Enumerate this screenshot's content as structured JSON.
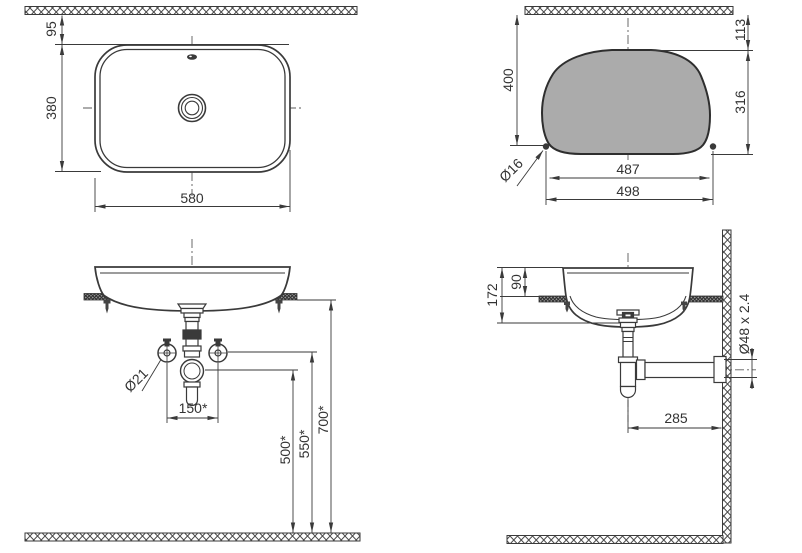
{
  "title": "washbasin installation drawing",
  "colors": {
    "line": "#3a3a3a",
    "cutout_fill": "#ababab",
    "text": "#333333"
  },
  "views": {
    "top": {
      "label": "top-view",
      "dims": {
        "wall_offset": "95",
        "depth": "380",
        "width": "580"
      }
    },
    "cutout": {
      "label": "cutout-template-view",
      "dims": {
        "wall_to_base": "400",
        "wall_to_top": "113",
        "height": "316",
        "hole": "Ø16",
        "width_inner": "487",
        "width_outer": "498"
      }
    },
    "front": {
      "label": "front-elevation",
      "dims": {
        "supply": "Ø21",
        "tap_spacing": "150*",
        "trap_outlet_height": "500*",
        "supply_height": "550*",
        "counter_height": "700*"
      }
    },
    "side": {
      "label": "side-elevation",
      "dims": {
        "basin_height": "172",
        "rim_above_counter": "90",
        "waste_pipe": "Ø48 x 2.4",
        "drain_to_wall": "285"
      }
    }
  }
}
